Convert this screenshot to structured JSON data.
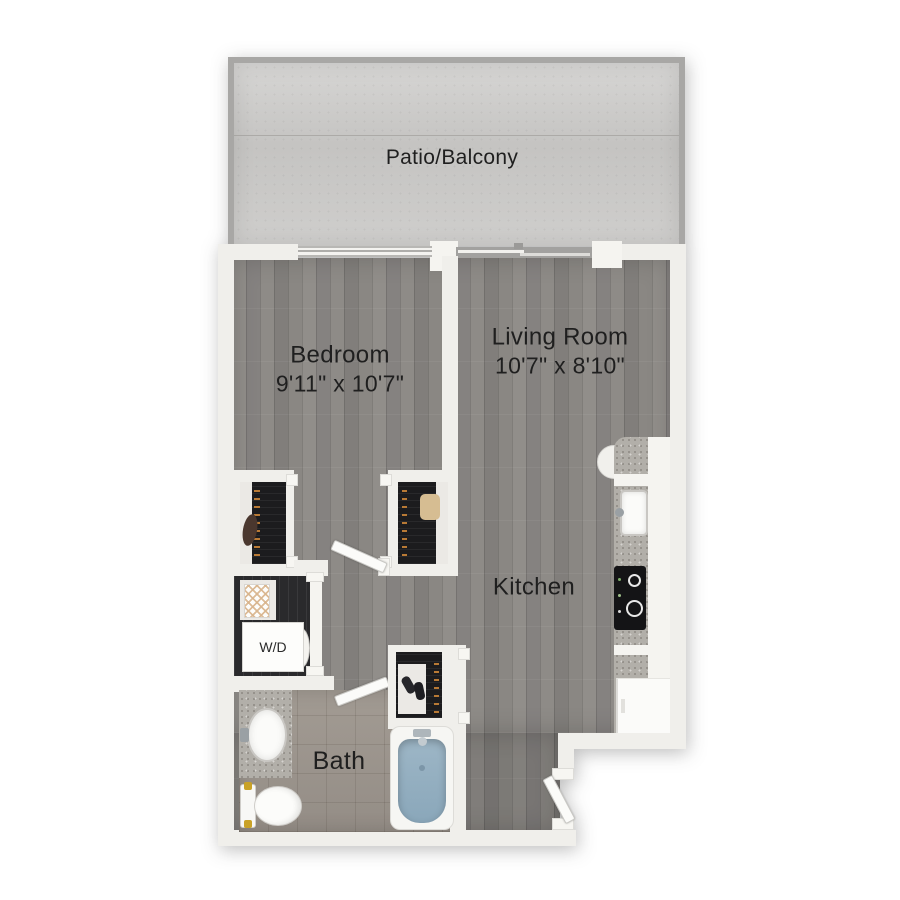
{
  "plan_type": "apartment-floor-plan",
  "rooms": {
    "patio": {
      "label": "Patio/Balcony"
    },
    "bedroom": {
      "label": "Bedroom",
      "dims": "9'11\" x 10'7\""
    },
    "living_room": {
      "label": "Living Room",
      "dims": "10'7\" x 8'10\""
    },
    "kitchen": {
      "label": "Kitchen"
    },
    "bath": {
      "label": "Bath"
    },
    "laundry": {
      "label": "W/D"
    }
  },
  "fixtures": [
    "bathtub",
    "toilet",
    "vanity-sink",
    "washer-dryer",
    "hamper",
    "kitchen-sink",
    "stove-cooktop",
    "refrigerator",
    "kitchen-counter",
    "bedroom-closet",
    "hall-closet",
    "coat-closet",
    "entry-door",
    "bedroom-door",
    "bathroom-door",
    "bedroom-window",
    "patio-sliding-door",
    "patio-railing"
  ],
  "colors": {
    "background": "#ffffff",
    "wall": "#f0efeb",
    "wood_floor": "#8b8884",
    "tile_floor": "#9b948d",
    "patio_concrete": "#cbcac8",
    "patio_railing": "#a8a7a5",
    "closet_interior": "#1c1c1e",
    "countertop": "#b2afa9",
    "tub_water": "#94aec0",
    "text": "#1f1f1f"
  }
}
